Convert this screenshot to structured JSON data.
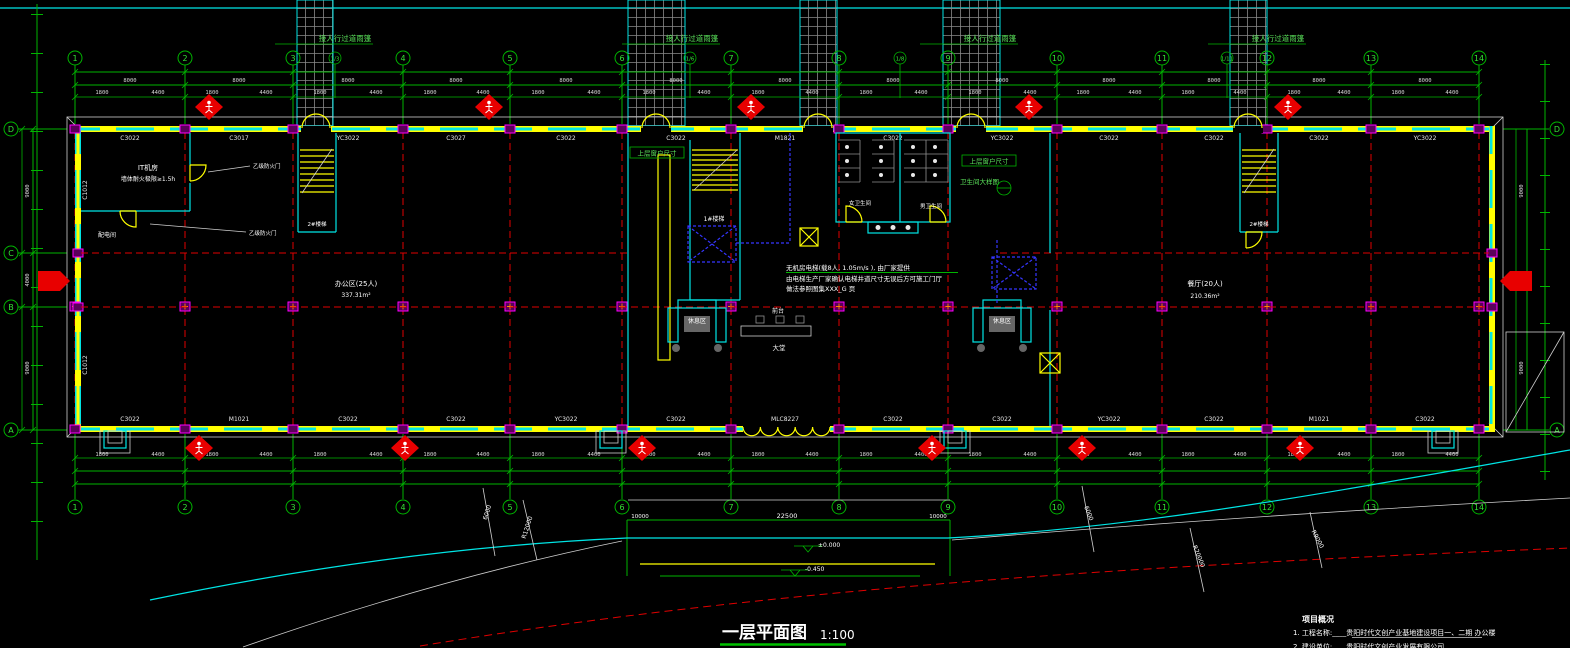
{
  "title": {
    "text": "一层平面图",
    "scale": "1:100"
  },
  "notes": {
    "heading": "项目概况",
    "line1": "1.    工程名称:____贵阳时代文创产业基地建设项目一、二期  办公楼",
    "line2": "2.    建设单位:____贵阳时代文创产业发展有限公司"
  },
  "canopy": {
    "label": "接人行过道雨篷",
    "positions": [
      {
        "x": 345,
        "y": 41
      },
      {
        "x": 692,
        "y": 41
      },
      {
        "x": 990,
        "y": 41
      },
      {
        "x": 1278,
        "y": 41
      }
    ]
  },
  "grids": {
    "top": [
      {
        "label": "1",
        "x": 75
      },
      {
        "label": "2",
        "x": 185
      },
      {
        "label": "3",
        "x": 293
      },
      {
        "label": "4",
        "x": 403
      },
      {
        "label": "5",
        "x": 510
      },
      {
        "label": "6",
        "x": 622
      },
      {
        "label": "7",
        "x": 731
      },
      {
        "label": "8",
        "x": 839
      },
      {
        "label": "9",
        "x": 948
      },
      {
        "label": "10",
        "x": 1057
      },
      {
        "label": "11",
        "x": 1162
      },
      {
        "label": "12",
        "x": 1267
      },
      {
        "label": "13",
        "x": 1371
      },
      {
        "label": "14",
        "x": 1479
      }
    ],
    "minor": [
      {
        "label": "1/3",
        "x": 335
      },
      {
        "label": "1/6",
        "x": 690
      },
      {
        "label": "1/8",
        "x": 900
      },
      {
        "label": "1/11",
        "x": 1227
      }
    ],
    "left": [
      {
        "label": "D",
        "y": 129
      },
      {
        "label": "C",
        "y": 253
      },
      {
        "label": "B",
        "y": 307
      },
      {
        "label": "A",
        "y": 430
      }
    ],
    "right": [
      {
        "label": "D",
        "y": 129
      },
      {
        "label": "A",
        "y": 430
      }
    ]
  },
  "dims": {
    "top_bays": [
      {
        "v": "8000",
        "x": 130
      },
      {
        "v": "8000",
        "x": 239
      },
      {
        "v": "8000",
        "x": 348
      },
      {
        "v": "8000",
        "x": 456
      },
      {
        "v": "8000",
        "x": 566
      },
      {
        "v": "8000",
        "x": 676
      },
      {
        "v": "8000",
        "x": 785
      },
      {
        "v": "8000",
        "x": 893
      },
      {
        "v": "8000",
        "x": 1002
      },
      {
        "v": "8000",
        "x": 1109
      },
      {
        "v": "8000",
        "x": 1214
      },
      {
        "v": "8000",
        "x": 1319
      },
      {
        "v": "8000",
        "x": 1425
      }
    ],
    "top_sub": [
      {
        "v": "1800",
        "x": 102
      },
      {
        "v": "4400",
        "x": 158
      },
      {
        "v": "1800",
        "x": 212
      },
      {
        "v": "4400",
        "x": 266
      },
      {
        "v": "1800",
        "x": 320
      },
      {
        "v": "4400",
        "x": 376
      },
      {
        "v": "1800",
        "x": 430
      },
      {
        "v": "4400",
        "x": 483
      },
      {
        "v": "1800",
        "x": 538
      },
      {
        "v": "4400",
        "x": 594
      },
      {
        "v": "1800",
        "x": 649
      },
      {
        "v": "4400",
        "x": 704
      },
      {
        "v": "1800",
        "x": 758
      },
      {
        "v": "4400",
        "x": 812
      },
      {
        "v": "1800",
        "x": 866
      },
      {
        "v": "4400",
        "x": 921
      },
      {
        "v": "1800",
        "x": 975
      },
      {
        "v": "4400",
        "x": 1030
      },
      {
        "v": "1800",
        "x": 1083
      },
      {
        "v": "4400",
        "x": 1135
      },
      {
        "v": "1800",
        "x": 1188
      },
      {
        "v": "4400",
        "x": 1240
      },
      {
        "v": "1800",
        "x": 1294
      },
      {
        "v": "4400",
        "x": 1344
      },
      {
        "v": "1800",
        "x": 1398
      },
      {
        "v": "4400",
        "x": 1452
      }
    ],
    "left_bays": [
      {
        "v": "9000",
        "y": 191
      },
      {
        "v": "4000",
        "y": 280
      },
      {
        "v": "9000",
        "y": 368
      }
    ],
    "entrance_width": "22500",
    "entrance_side": "10000"
  },
  "codes": {
    "top": [
      {
        "v": "C3022",
        "x": 130
      },
      {
        "v": "C3017",
        "x": 239
      },
      {
        "v": "YC3022",
        "x": 348
      },
      {
        "v": "C3027",
        "x": 456
      },
      {
        "v": "C3022",
        "x": 566
      },
      {
        "v": "C3022",
        "x": 676
      },
      {
        "v": "M1821",
        "x": 785
      },
      {
        "v": "C3022",
        "x": 893
      },
      {
        "v": "YC3022",
        "x": 1002
      },
      {
        "v": "C3022",
        "x": 1109
      },
      {
        "v": "C3022",
        "x": 1214
      },
      {
        "v": "C3022",
        "x": 1319
      },
      {
        "v": "YC3022",
        "x": 1425
      }
    ],
    "bottom": [
      {
        "v": "C3022",
        "x": 130
      },
      {
        "v": "M1021",
        "x": 239
      },
      {
        "v": "C3022",
        "x": 348
      },
      {
        "v": "C3022",
        "x": 456
      },
      {
        "v": "YC3022",
        "x": 566
      },
      {
        "v": "C3022",
        "x": 676
      },
      {
        "v": "MLC8227",
        "x": 785
      },
      {
        "v": "C3022",
        "x": 893
      },
      {
        "v": "C3022",
        "x": 1002
      },
      {
        "v": "YC3022",
        "x": 1109
      },
      {
        "v": "C3022",
        "x": 1214
      },
      {
        "v": "M1021",
        "x": 1319
      },
      {
        "v": "C3022",
        "x": 1425
      }
    ],
    "left_wall": [
      {
        "v": "C1012",
        "y": 190
      },
      {
        "v": "C1012",
        "y": 365
      }
    ]
  },
  "rooms": {
    "it1": "IT机房",
    "it2": "墙体耐火极限≥1.5h",
    "power": "配电间",
    "stair1": "1#楼梯",
    "stair2": "2#楼梯",
    "office": "办公区(25人)",
    "office_area": "337.31m²",
    "dining": "餐厅(20人)",
    "dining_area": "210.36m²",
    "wc_w": "女卫生间",
    "wc_m": "男卫生间",
    "lounge": "休息区",
    "desk": "前台",
    "lobby": "大堂",
    "upper_window": "上层窗户尺寸",
    "wc_detail": "卫生间大样图",
    "fire_door": "乙级防火门"
  },
  "elevator_note": {
    "l1": "无机房电梯(载8人, 1.05m/s ), 由厂家提供",
    "l2": "由电梯生产厂家确认电梯井道尺寸无误后方可施工门厅",
    "l3": "做法参照图集XXX_G  页"
  },
  "levels": {
    "zero": "±0.000",
    "minus": "-0.450"
  },
  "road_dims": [
    {
      "v": "6000",
      "x": 489,
      "y": 513,
      "r": -72
    },
    {
      "v": "R12000",
      "x": 529,
      "y": 528,
      "r": -72
    },
    {
      "v": "6000",
      "x": 1087,
      "y": 514,
      "r": 68
    },
    {
      "v": "R20000",
      "x": 1197,
      "y": 557,
      "r": 68
    },
    {
      "v": "R9000",
      "x": 1316,
      "y": 540,
      "r": 62
    }
  ],
  "markers": {
    "diamonds_top": [
      {
        "x": 209,
        "y": 107
      },
      {
        "x": 489,
        "y": 107
      },
      {
        "x": 751,
        "y": 107
      },
      {
        "x": 1029,
        "y": 107
      },
      {
        "x": 1288,
        "y": 107
      }
    ],
    "diamonds_bottom": [
      {
        "x": 199,
        "y": 448
      },
      {
        "x": 405,
        "y": 448
      },
      {
        "x": 642,
        "y": 448
      },
      {
        "x": 932,
        "y": 448
      },
      {
        "x": 1082,
        "y": 448
      },
      {
        "x": 1300,
        "y": 448
      }
    ]
  },
  "walkways": [
    {
      "x": 297,
      "w": 36
    },
    {
      "x": 628,
      "w": 57
    },
    {
      "x": 800,
      "w": 37
    },
    {
      "x": 943,
      "w": 57
    },
    {
      "x": 1230,
      "w": 37
    }
  ],
  "top_doors": [
    {
      "x": 316
    },
    {
      "x": 656
    },
    {
      "x": 818
    },
    {
      "x": 971
    },
    {
      "x": 1248
    }
  ],
  "colors": {
    "background": "#000000",
    "grid_green": "#00b400",
    "wall_yellow": "#ffff00",
    "window_cyan": "#00e5e5",
    "column_magenta": "#ff00ff",
    "axis_red": "#e00000",
    "marker_red": "#ff0000",
    "elevator_blue": "#3535ff",
    "text_white": "#ffffff"
  }
}
